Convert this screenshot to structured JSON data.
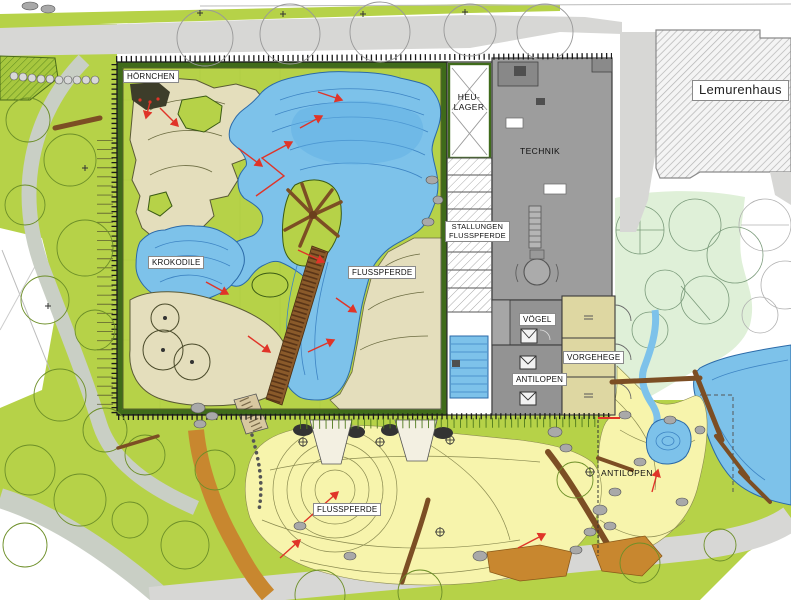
{
  "plan": {
    "type": "zoo-site-plan",
    "labels": {
      "hoernchen": "HÖRNCHEN",
      "heu_lager_line1": "HEU-",
      "heu_lager_line2": "LAGER",
      "technik": "TECHNIK",
      "stallungen_line1": "STALLUNGEN",
      "stallungen_line2": "FLUSSPFERDE",
      "krokodile": "KROKODILE",
      "flusspferde_halle": "FLUSSPFERDE",
      "voegel": "VÖGEL",
      "vorgehege": "VORGEHEGE",
      "antilopen_stall": "ANTILOPEN",
      "lemurenhaus": "Lemurenhaus",
      "antilopen_anlage": "ANTILOPEN",
      "flusspferde_anlage": "FLUSSPFERDE"
    },
    "colors": {
      "grass": "#b6d248",
      "grass_dark": "#6d9422",
      "water": "#7dc2ea",
      "water_line": "#3e85c4",
      "sand": "#e4debc",
      "pale_yellow": "#f7f4ac",
      "mint": "#dff0d8",
      "pen_beige": "#ded7a2",
      "building_gray": "#9d9d9d",
      "room_gray": "#939393",
      "road_gray": "#d7d7d5",
      "path_gray": "#c9cfc5",
      "path_orange": "#c8872f",
      "wood_brown": "#7c4e24",
      "rock_gray": "#a9a9a9",
      "wall_green": "#3f6b1a",
      "marker_red": "#e03428"
    }
  }
}
